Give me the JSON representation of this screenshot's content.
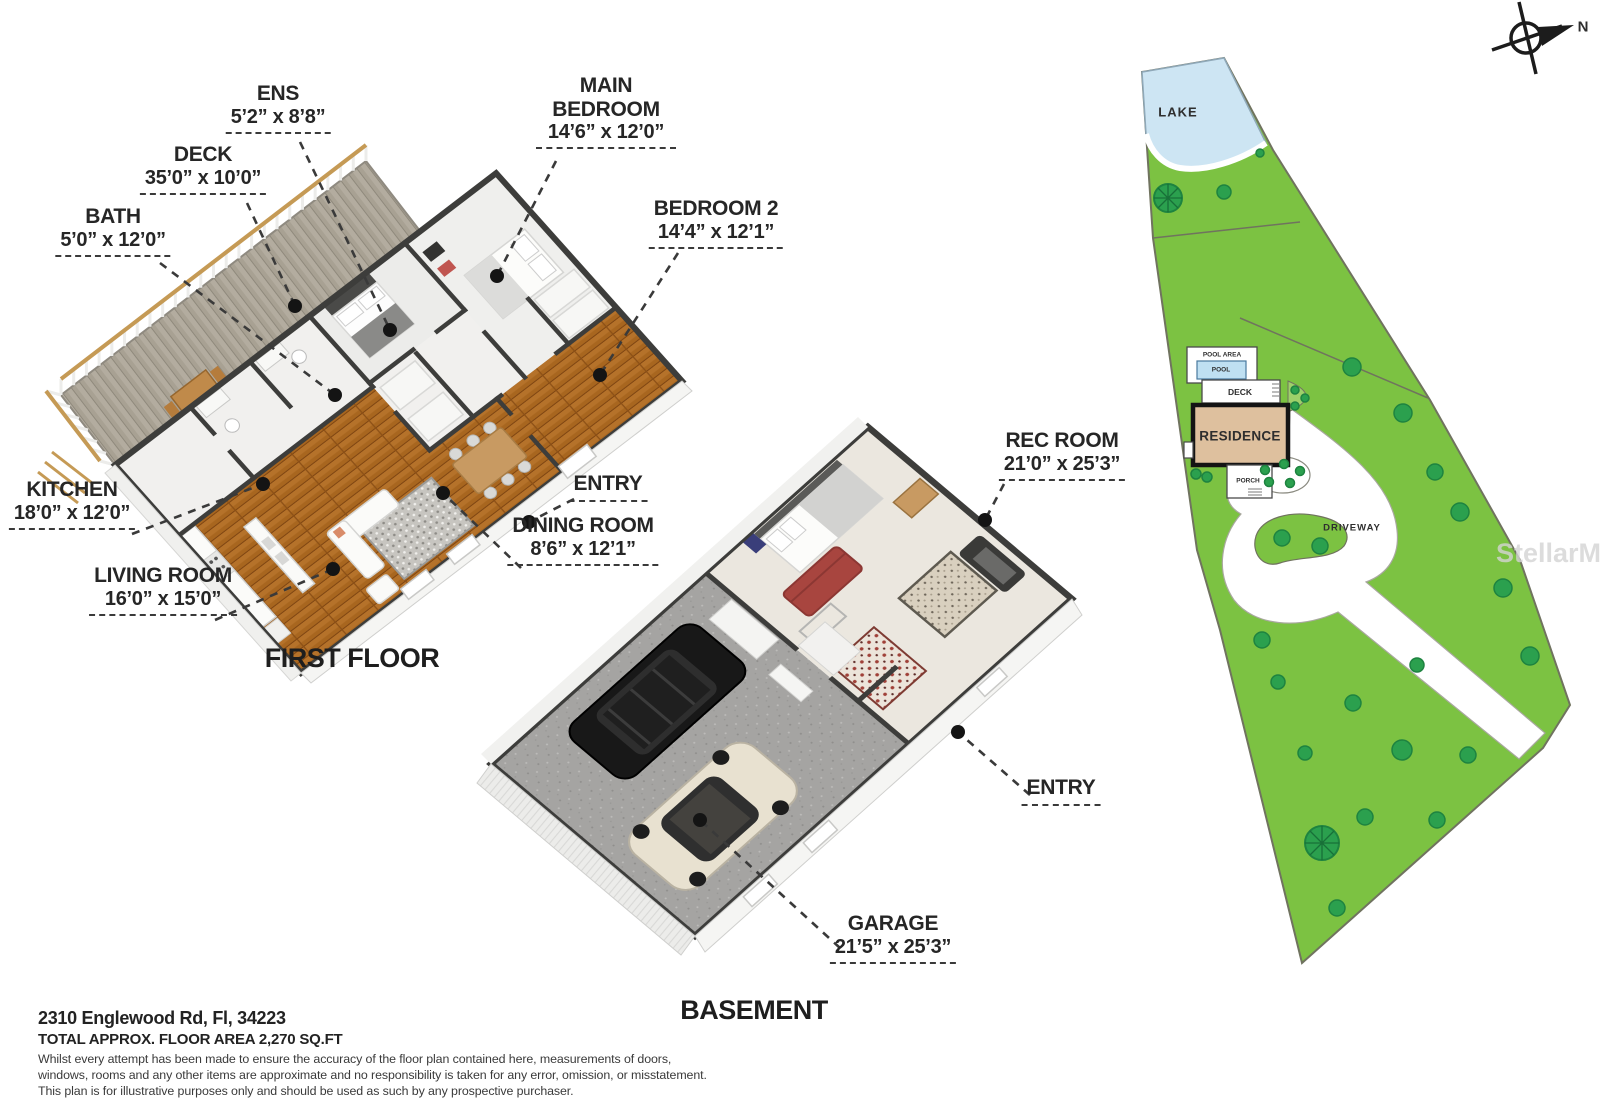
{
  "first_floor": {
    "title": "FIRST FLOOR",
    "rooms": [
      {
        "name": "ENS",
        "dims": "5’2” x 8’8”"
      },
      {
        "name": "DECK",
        "dims": "35’0” x 10’0”"
      },
      {
        "name": "BATH",
        "dims": "5’0” x 12’0”"
      },
      {
        "name": "MAIN BEDROOM",
        "dims": "14’6” x 12’0”"
      },
      {
        "name": "BEDROOM 2",
        "dims": "14’4” x 12’1”"
      },
      {
        "name": "KITCHEN",
        "dims": "18’0” x 12’0”"
      },
      {
        "name": "LIVING ROOM",
        "dims": "16’0” x 15’0”"
      },
      {
        "name": "ENTRY",
        "dims": ""
      },
      {
        "name": "DINING ROOM",
        "dims": "8’6” x 12’1”"
      }
    ]
  },
  "basement": {
    "title": "BASEMENT",
    "rooms": [
      {
        "name": "REC ROOM",
        "dims": "21’0” x 25’3”"
      },
      {
        "name": "ENTRY",
        "dims": ""
      },
      {
        "name": "GARAGE",
        "dims": "21’5” x 25’3”"
      }
    ]
  },
  "site_plan": {
    "labels": {
      "lake": "LAKE",
      "pool_area": "POOL AREA",
      "pool": "POOL",
      "deck": "DECK",
      "residence": "RESIDENCE",
      "porch": "PORCH",
      "driveway": "DRIVEWAY"
    },
    "compass_north": "N",
    "watermark": "StellarMLS",
    "colors": {
      "grass": "#7cc242",
      "lake": "#cde5f3",
      "pool": "#bfe0f2",
      "residence": "#dec09e",
      "tree": "#2ba04e"
    }
  },
  "footer": {
    "address": "2310 Englewood Rd, Fl, 34223",
    "area": "TOTAL APPROX. FLOOR AREA 2,270 SQ.FT",
    "disclaimer_lines": [
      "Whilst every attempt has been made to ensure the accuracy of the floor plan contained here, measurements of doors,",
      "windows, rooms and any other items are approximate and no responsibility is taken for any error, omission, or misstatement.",
      "This plan is for illustrative purposes only and should be used as such by any prospective purchaser."
    ]
  }
}
